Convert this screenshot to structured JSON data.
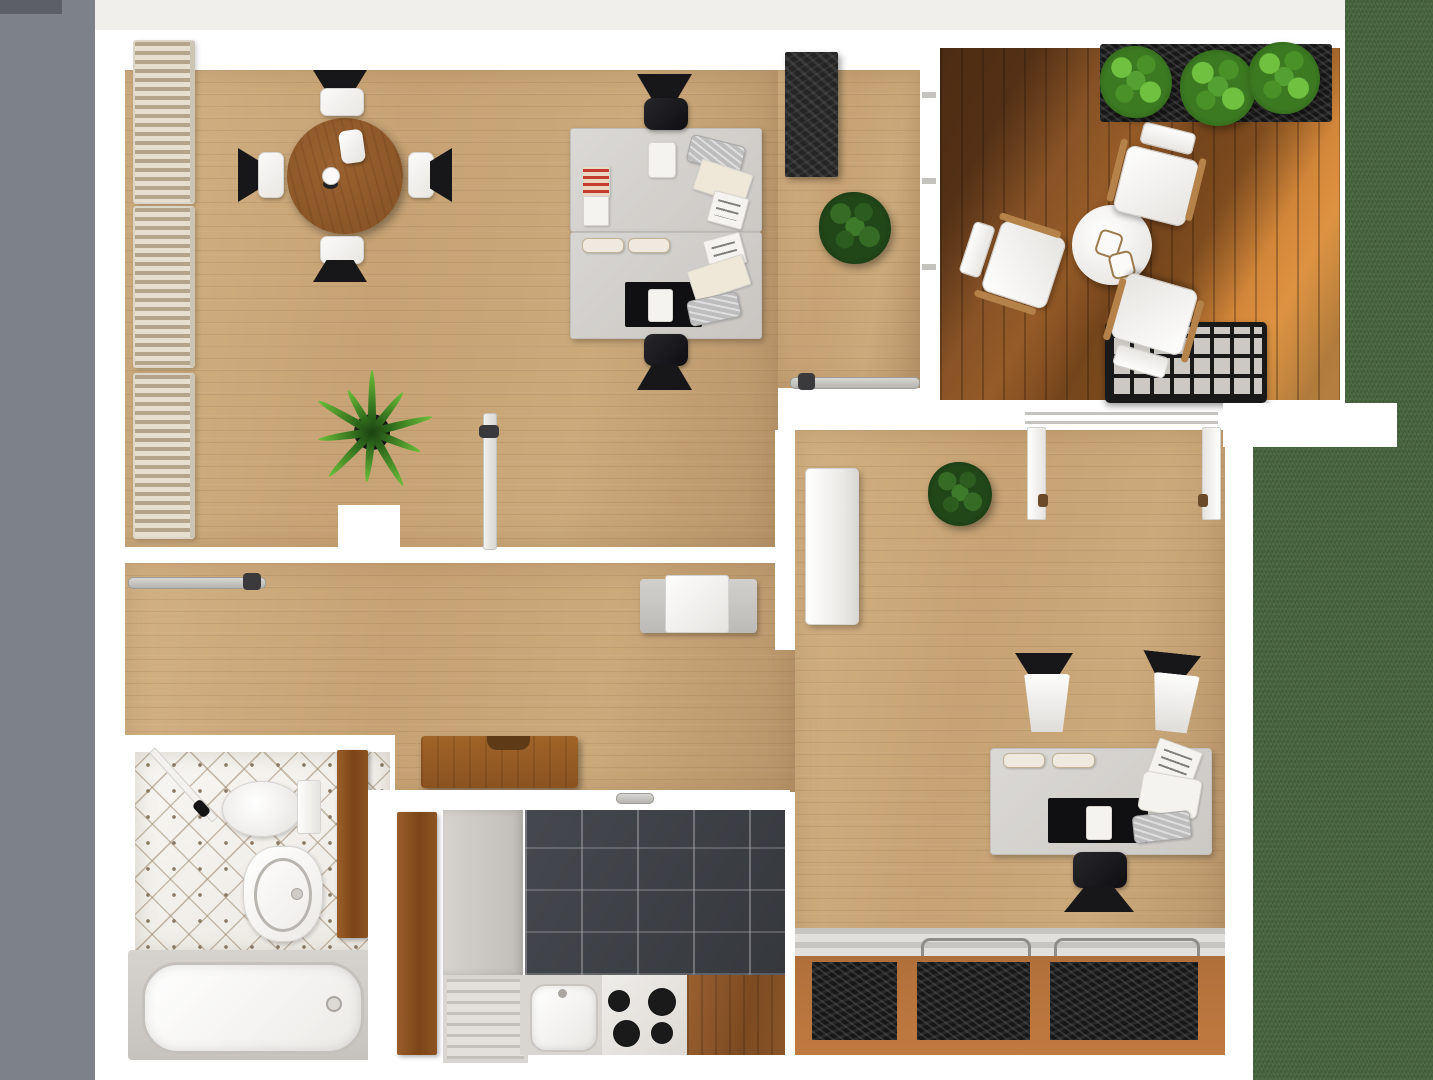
{
  "scene": {
    "kind": "3d-floor-plan-render",
    "view": "top-down",
    "rooms": [
      {
        "id": "living-dining",
        "label": "living and dining room",
        "floor": "light oak plank"
      },
      {
        "id": "balcony",
        "label": "sunlit balcony terrace",
        "floor": "teak deck"
      },
      {
        "id": "office",
        "label": "office room",
        "floor": "light oak plank"
      },
      {
        "id": "hallway",
        "label": "hallway",
        "floor": "light oak plank"
      },
      {
        "id": "bathroom",
        "label": "bathroom",
        "floor": "white diamond mosaic tile"
      },
      {
        "id": "kitchen",
        "label": "kitchen",
        "floor": "dark slate tile"
      },
      {
        "id": "lawn",
        "label": "garden lawn",
        "floor": "grass"
      }
    ],
    "counts": {
      "dining_chairs": 4,
      "living_room_radiators": 3,
      "living_room_desks": 2,
      "balcony_lounge_chairs": 3,
      "balcony_planter_bushes": 3,
      "office_desk_chairs": 2,
      "office_floor_planters": 3,
      "stove_burners": 4
    },
    "furniture": [
      "round dining table with pitcher and cup",
      "four dining chairs",
      "three wall radiators",
      "two facing desks with papers, notepads, keyboards and desk mats",
      "two black office chairs",
      "black sideboard",
      "potted palm plant",
      "two potted bush plants",
      "hallway side table",
      "hallway dresser",
      "sliding glass doors",
      "balcony round coffee table with two cups",
      "three balcony lounge chairs",
      "balcony plant trough with three bushes",
      "slatted crate table",
      "office desk with monitor mat, printer and trays",
      "office TV cabinet",
      "french balcony doors",
      "three floor planters with radiator",
      "toilet",
      "wash basin",
      "bathtub",
      "toilet brush",
      "kitchen sink with drainboard",
      "four-burner stove",
      "wooden worktop",
      "fridge cabinet"
    ]
  },
  "palette": {
    "exterior_gray": "#7d828a",
    "exterior_dark": "#5c6066",
    "wall_white": "#ffffff",
    "margin_light": "#f1efec",
    "wood_base": "#c6a274",
    "wood_hi": "#d2b184",
    "wood_lo": "#b8946a",
    "deck_dark": "#6b4220",
    "deck_sun": "#edab55",
    "grass_green": "#44613b",
    "kitchen_tile": "#35383d",
    "bath_tile": "#ece9e3",
    "counter_gray": "#d6d4d0",
    "furn_black": "#1e1e1e",
    "plant_dark": "#214618",
    "plant_bright": "#55a032",
    "dining_table_wood": "#8a5527",
    "door_wood": "#8a5223",
    "planter_frame_wood": "#b06f3a",
    "notepad_red": "#c23b2e"
  }
}
